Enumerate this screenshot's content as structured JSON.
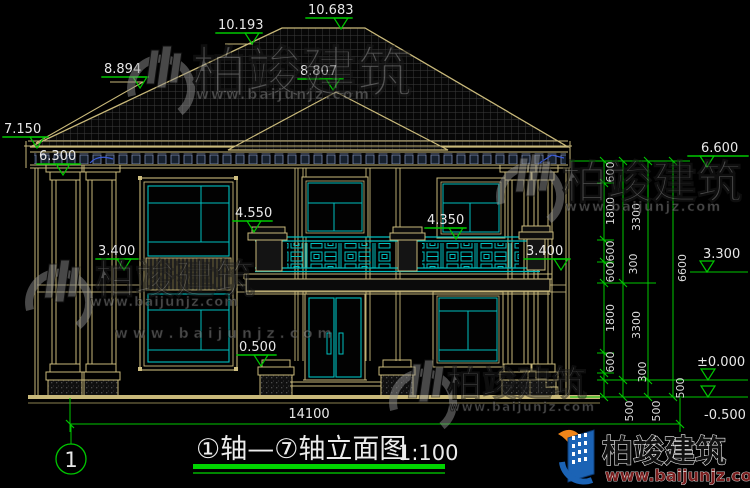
{
  "drawing": {
    "title": "①轴—⑦轴立面图",
    "scale": "1:100",
    "axis_bubble": "1"
  },
  "elevation_markers": {
    "ridge_main": "10.683",
    "ridge_left": "10.193",
    "ridge_low_left": "8.894",
    "gable_center": "8.807",
    "eave_left_top": "7.150",
    "eave_left_bottom": "6.300",
    "balcony_left": "4.550",
    "balcony_center": "4.350",
    "floor2_left": "3.400",
    "floor2_right": "3.400",
    "porch": "0.500",
    "eave_right": "6.600",
    "floor2_dim_right": "3.300",
    "ground_zero": "±0.000",
    "grade": "-0.500"
  },
  "dimensions": {
    "total_width": "14100",
    "v600": "600",
    "v1800": "1800",
    "v300": "300",
    "v500": "500",
    "v3300": "3300",
    "v6600": "6600"
  },
  "watermark": {
    "brand": "柏竣建筑",
    "website": "www.baijunjz.com",
    "website_spaced": "w w w . b a i j u n j z . c o m"
  },
  "logo": {
    "brand": "柏竣建筑",
    "website": "www.baijunjz.com"
  }
}
